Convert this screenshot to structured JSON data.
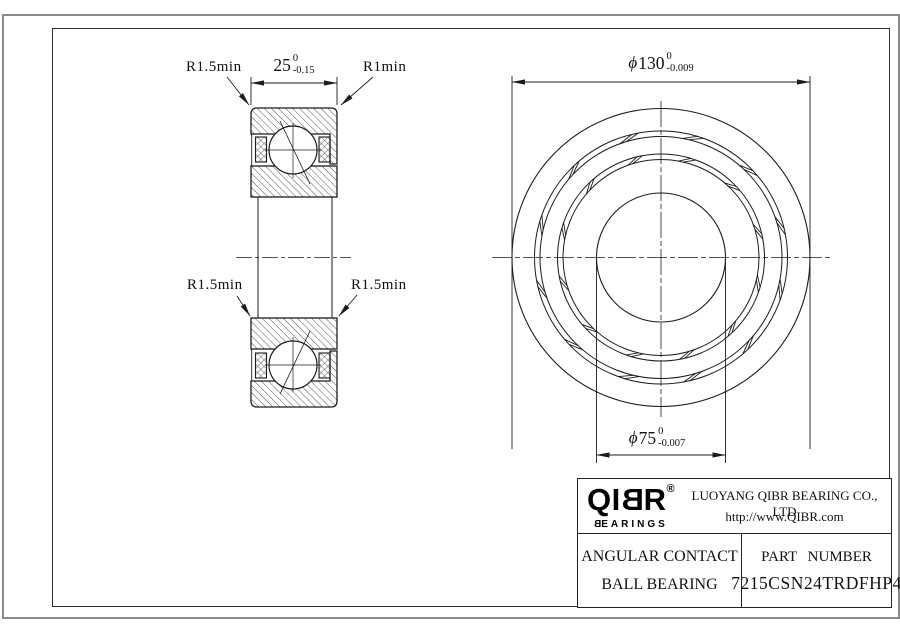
{
  "drawing": {
    "section_view": {
      "width_dim": {
        "nominal": "25",
        "tol_upper": "0",
        "tol_lower": "-0.15"
      },
      "chamfer_labels": {
        "top_left": "R1.5min",
        "top_right": "R1min",
        "bottom_left": "R1.5min",
        "bottom_right": "R1.5min"
      }
    },
    "front_view": {
      "outer_dia_dim": {
        "symbol": "ϕ",
        "nominal": "130",
        "tol_upper": "0",
        "tol_lower": "-0.009"
      },
      "bore_dia_dim": {
        "symbol": "ϕ",
        "nominal": "75",
        "tol_upper": "0",
        "tol_lower": "-0.007"
      }
    }
  },
  "title_block": {
    "logo": {
      "part1": "QI",
      "mirrored_b": "B",
      "part2": "R",
      "registered": "®",
      "subtitle_first": "B",
      "subtitle_rest": "EARINGS"
    },
    "company_name": "LUOYANG QIBR BEARING CO., LTD",
    "website": "http://www.QIBR.com",
    "product": {
      "line1": "ANGULAR CONTACT",
      "line2": "BALL BEARING"
    },
    "part_number_label": "PART NUMBER",
    "part_number": "7215CSN24TRDFHP4"
  }
}
